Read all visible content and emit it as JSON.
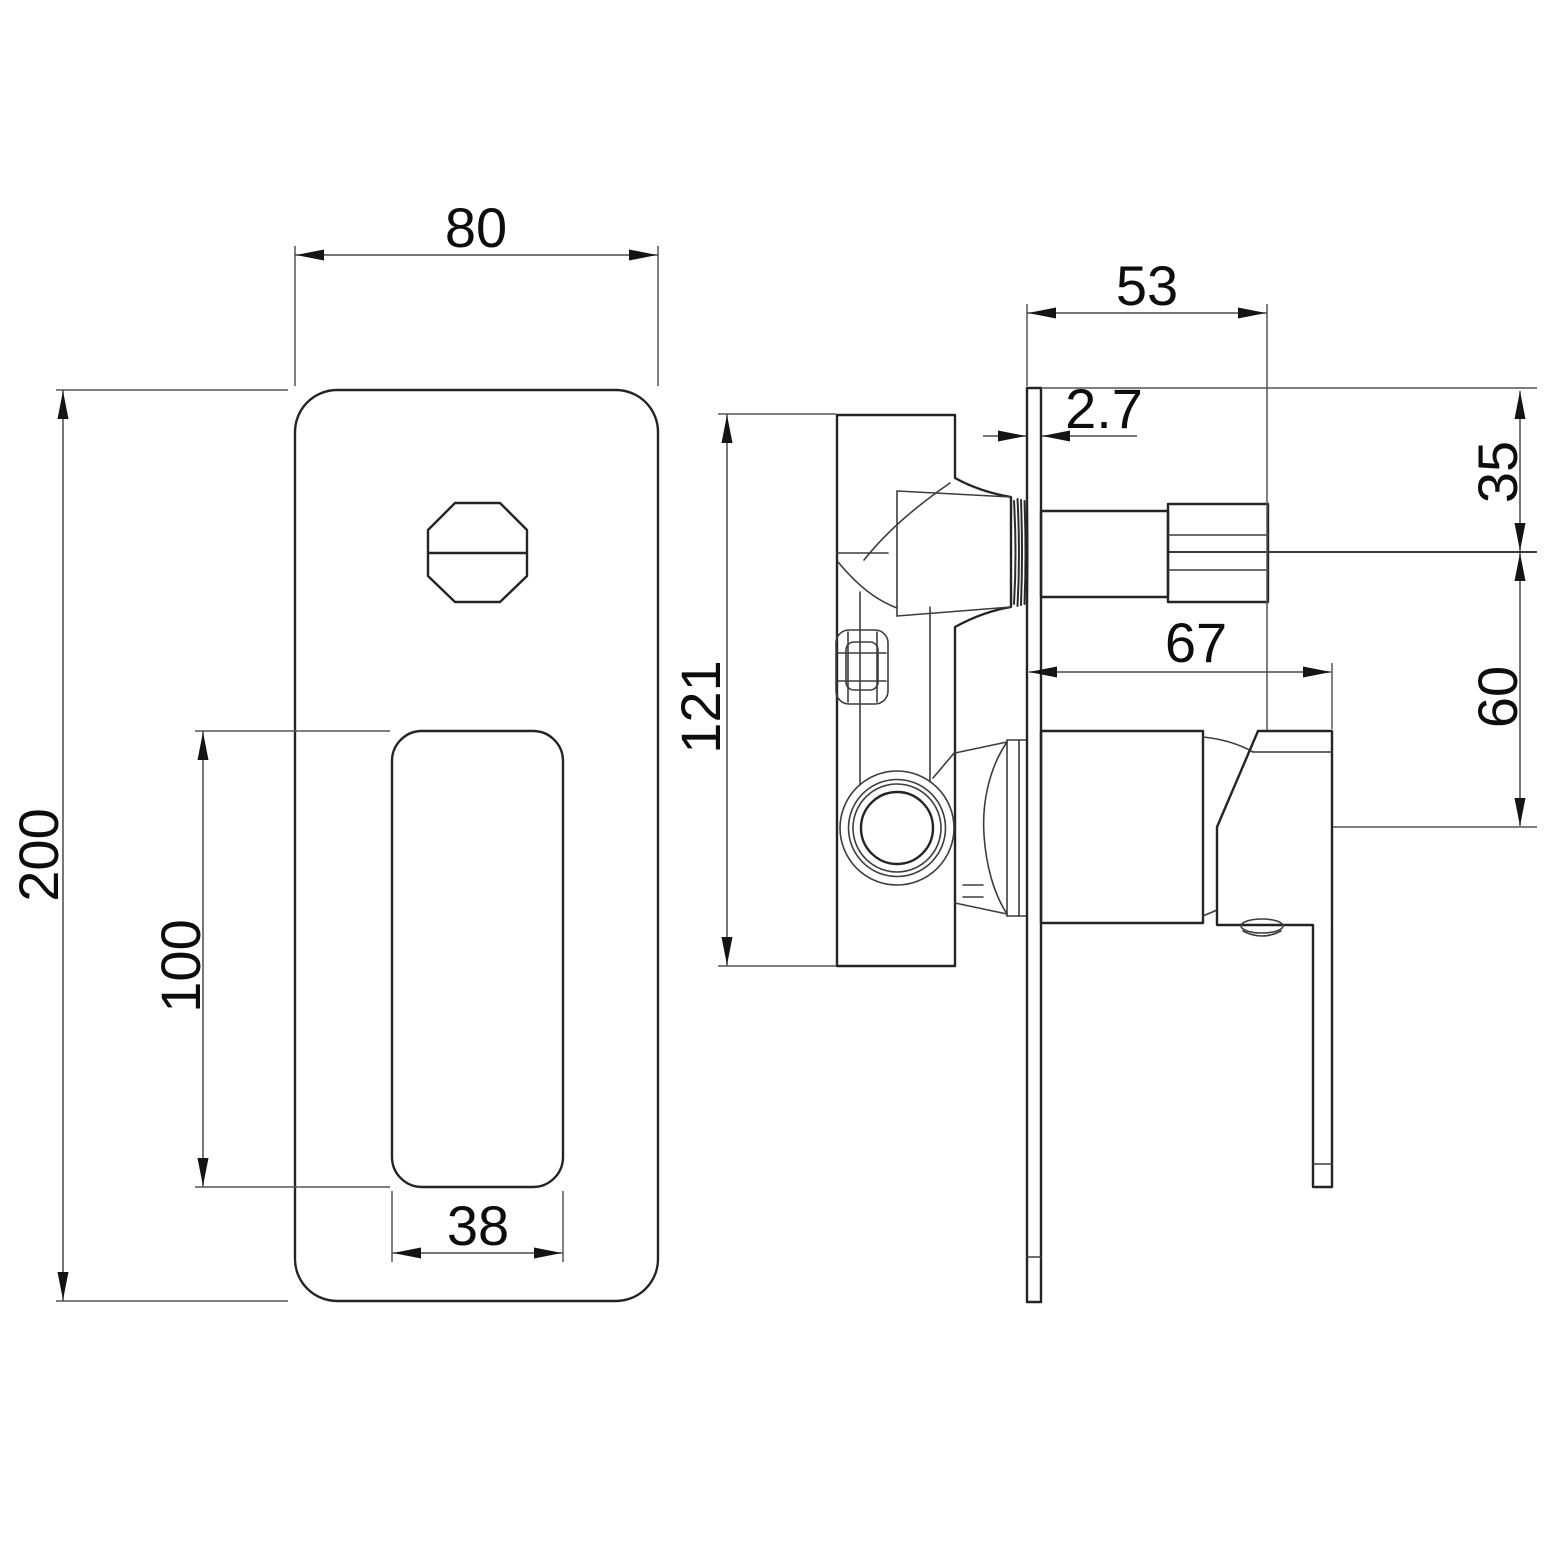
{
  "drawing": {
    "type": "technical-dimension-drawing",
    "subject": "concealed shower mixer valve with diverter, front and side views",
    "background_color": "#ffffff",
    "line_color": "#242424",
    "unit": "mm",
    "front_view": {
      "dim_plate_width": "80",
      "dim_plate_height": "200",
      "dim_handle_height": "100",
      "dim_handle_width": "38"
    },
    "side_view": {
      "dim_body_height": "121",
      "dim_stem_length": "53",
      "dim_plate_thickness": "2.7",
      "dim_axis_from_top": "35",
      "dim_handle_projection": "67",
      "dim_axis_spacing": "60"
    }
  }
}
